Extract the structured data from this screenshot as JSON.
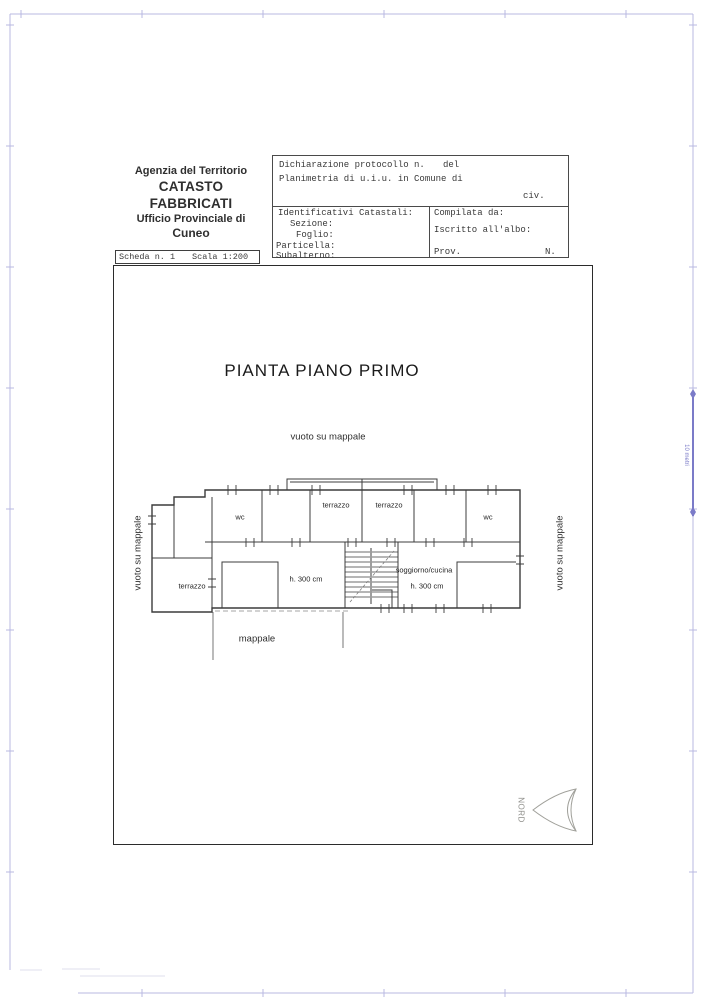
{
  "header": {
    "agency_line1": "Agenzia del Territorio",
    "agency_line2": "CATASTO FABBRICATI",
    "agency_line3": "Ufficio Provinciale di",
    "agency_line4": "Cuneo"
  },
  "form": {
    "dichiarazione": "Dichiarazione protocollo n.",
    "del": "del",
    "planimetria": "Planimetria di u.i.u. in Comune di",
    "civ": "civ.",
    "identificativi": "Identificativi Catastali:",
    "sezione": "Sezione:",
    "foglio": "Foglio:",
    "particella": "Particella:",
    "subalterno": "Subalterno:",
    "compilata": "Compilata da:",
    "iscritto": "Iscritto all'albo:",
    "prov": "Prov.",
    "n": "N."
  },
  "scheda": {
    "scheda_n": "Scheda n. 1",
    "scala": "Scala 1:200"
  },
  "drawing": {
    "title": "PIANTA PIANO PRIMO",
    "vuoto_top": "vuoto su mappale",
    "vuoto_left": "vuoto su mappale",
    "vuoto_right": "vuoto su mappale",
    "mappale": "mappale",
    "rooms": {
      "wc_left": "wc",
      "wc_right": "wc",
      "terrazzo_top_left": "terrazzo",
      "terrazzo_top_right": "terrazzo",
      "terrazzo_bottom_left": "terrazzo",
      "h_left": "h. 300 cm",
      "soggiorno": "soggiorno/cucina",
      "h_right": "h. 300 cm"
    }
  },
  "compass": {
    "label": "NORD"
  },
  "scale_bar": {
    "label": "10 metri"
  },
  "colors": {
    "ink": "#3a3a3a",
    "plan": "#3c3c3c",
    "frame": "#b9b9e2",
    "scalebar": "#7b7bc8",
    "compass": "#a0a09a",
    "title-ink": "#1a1a1a"
  }
}
